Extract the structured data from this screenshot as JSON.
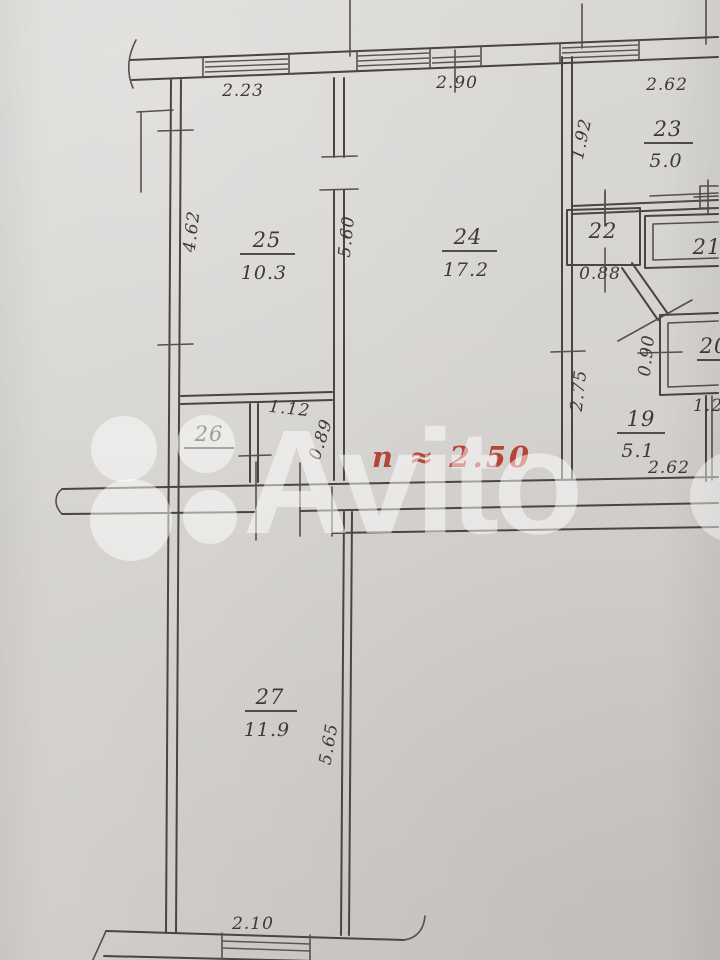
{
  "watermark": {
    "brand": "Avito"
  },
  "height_note": {
    "text": "n ≈ 2.50",
    "color": "#b5443a"
  },
  "rooms": {
    "r25": {
      "number": "25",
      "area": "10.3"
    },
    "r24": {
      "number": "24",
      "area": "17.2"
    },
    "r23": {
      "number": "23",
      "area": "5.0"
    },
    "r22": {
      "number": "22"
    },
    "r21": {
      "number": "21"
    },
    "r20": {
      "number": "20"
    },
    "r19": {
      "number": "19",
      "area": "5.1"
    },
    "r26": {
      "number": "26"
    },
    "r27": {
      "number": "27",
      "area": "11.9"
    }
  },
  "dimensions": {
    "top_room25": "2.23",
    "top_room24": "2.90",
    "top_room23": "2.62",
    "left_room25": "4.62",
    "wall_25_24": "5.60",
    "left_room23": "1.92",
    "below_room22": "0.88",
    "room26_opening": "1.12",
    "room26_wall": "0.89",
    "left_room19": "2.75",
    "left_room20": "0.90",
    "below_room20": "1.2",
    "below_room19": "2.62",
    "room27_wall": "5.65",
    "bottom_room27": "2.10"
  }
}
